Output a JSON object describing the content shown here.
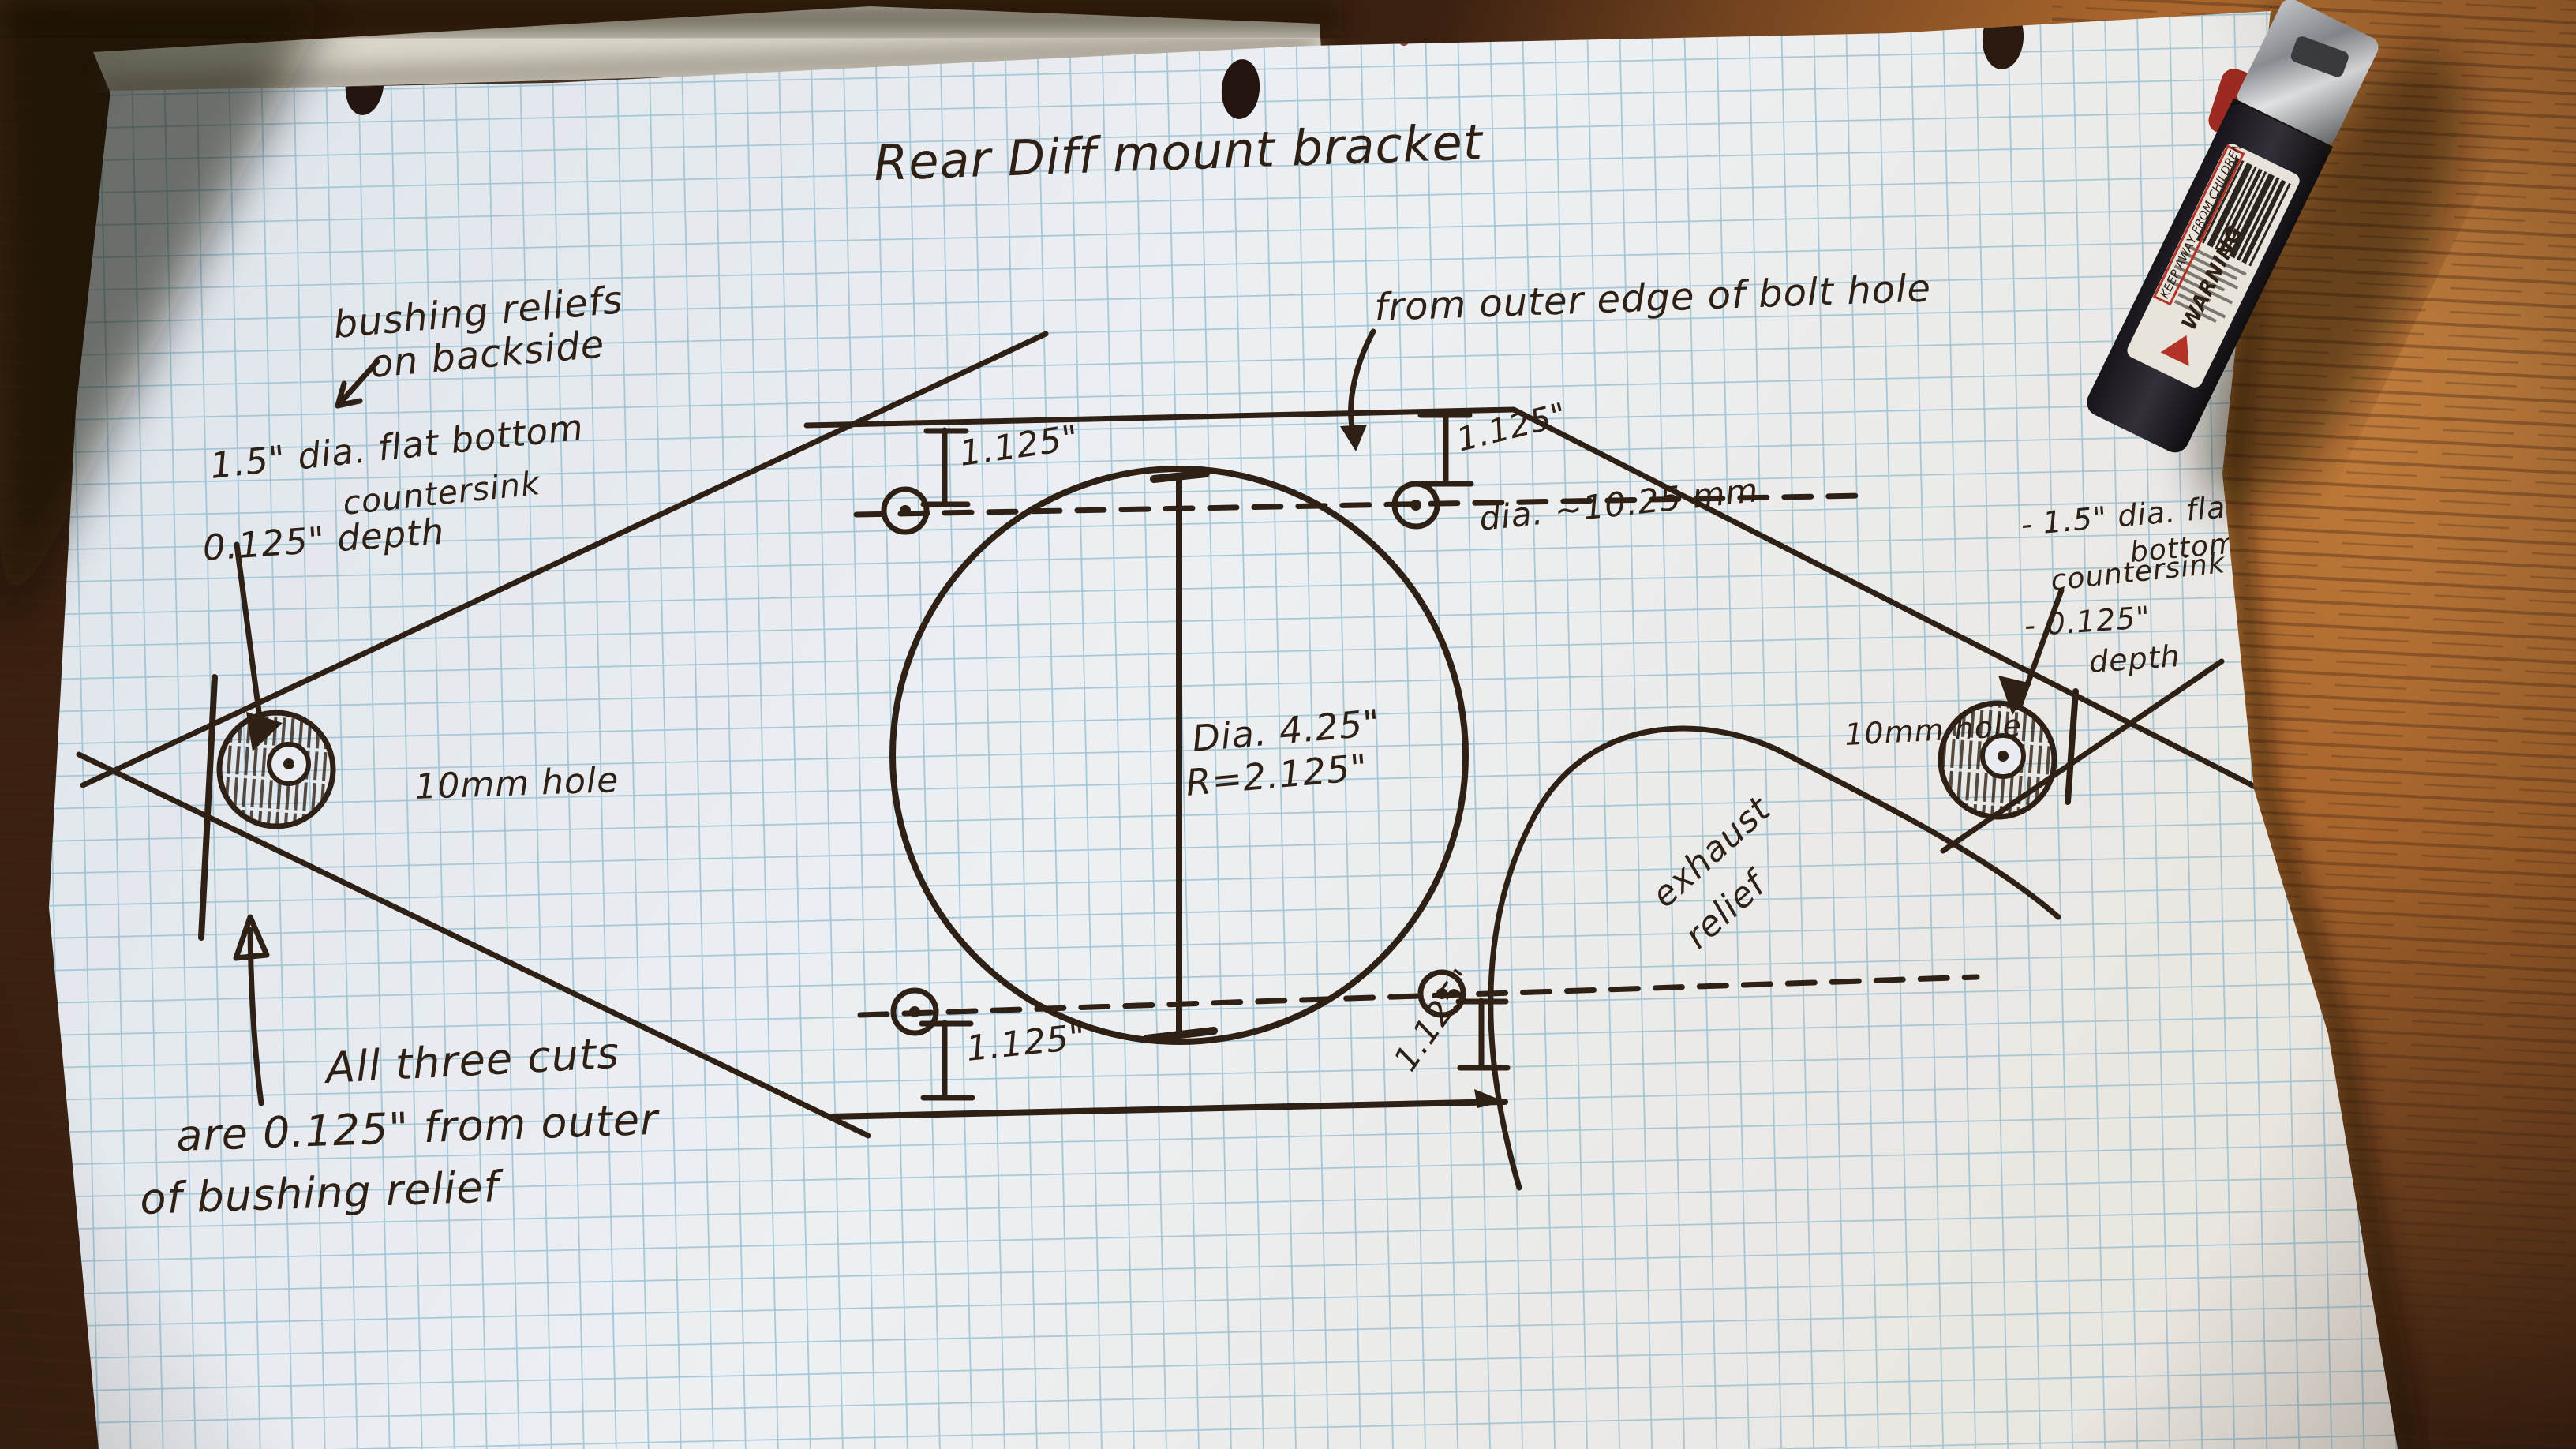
{
  "title": "Rear Diff mount bracket",
  "notes": {
    "bushing_reliefs": {
      "line1": "bushing reliefs",
      "line2": "on backside"
    },
    "left_countersink": {
      "line1": "1.5\" dia. flat bottom",
      "line2": "countersink",
      "line3": "0.125\" depth"
    },
    "bolt_hole_edge": "from outer edge of bolt hole",
    "right_countersink": {
      "line1": "- 1.5\" dia. flat",
      "line2": "bottom",
      "line3": "countersink",
      "line4": "- 0.125\"",
      "line5": "depth"
    },
    "exhaust_relief": {
      "line1": "exhaust",
      "line2": "relief"
    },
    "all_three_cuts": {
      "line1": "All three cuts",
      "line2": "are  0.125\" from outer",
      "line3": "of bushing relief"
    }
  },
  "labels": {
    "hole_left": "10mm hole",
    "hole_right": "10mm hole",
    "bolt_diameter": "dia. ~10.25 mm",
    "center_diameter": "Dia. 4.25\"",
    "center_radius": "R=2.125\"",
    "dim_top_left": "1.125\"",
    "dim_top_right": "1.125\"",
    "dim_bottom_left": "1.125\"",
    "dim_bottom_right": "1.125\""
  },
  "lighter": {
    "warning": "WARNING",
    "caution": "KEEP AWAY FROM CHILDREN"
  },
  "colors": {
    "ink": "#2e2015",
    "paper": "#e9edf2",
    "grid_blue": "#8fb9cd",
    "wood_bright": "#c98440",
    "wood_dark": "#472813",
    "warning_red": "#b23327"
  }
}
